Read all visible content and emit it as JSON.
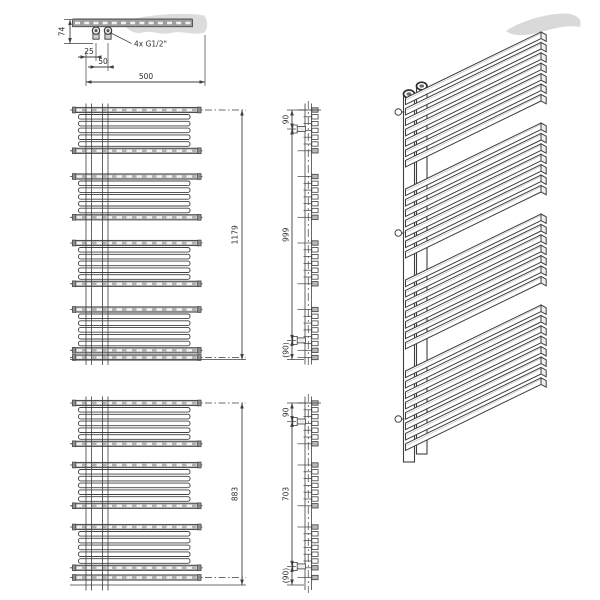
{
  "drawing_labels": {
    "top_view": {
      "depth": "74",
      "offset_edge": "25",
      "pipe_spacing": "50",
      "width": "500",
      "connections": "4x G1/2\""
    },
    "tall_model": {
      "overall_height": "1179",
      "bracket_top": "90",
      "bracket_span": "999",
      "bracket_bottom": "(90)"
    },
    "short_model": {
      "overall_height": "883",
      "bracket_top": "90",
      "bracket_span": "703",
      "bracket_bottom": "(90)"
    }
  },
  "colors": {
    "line": "#3f3f3f",
    "tube_gray": "#b0b0b0",
    "tube_cap": "#8f8f8f",
    "shadow": "#dcdcdc",
    "background": "#ffffff"
  }
}
